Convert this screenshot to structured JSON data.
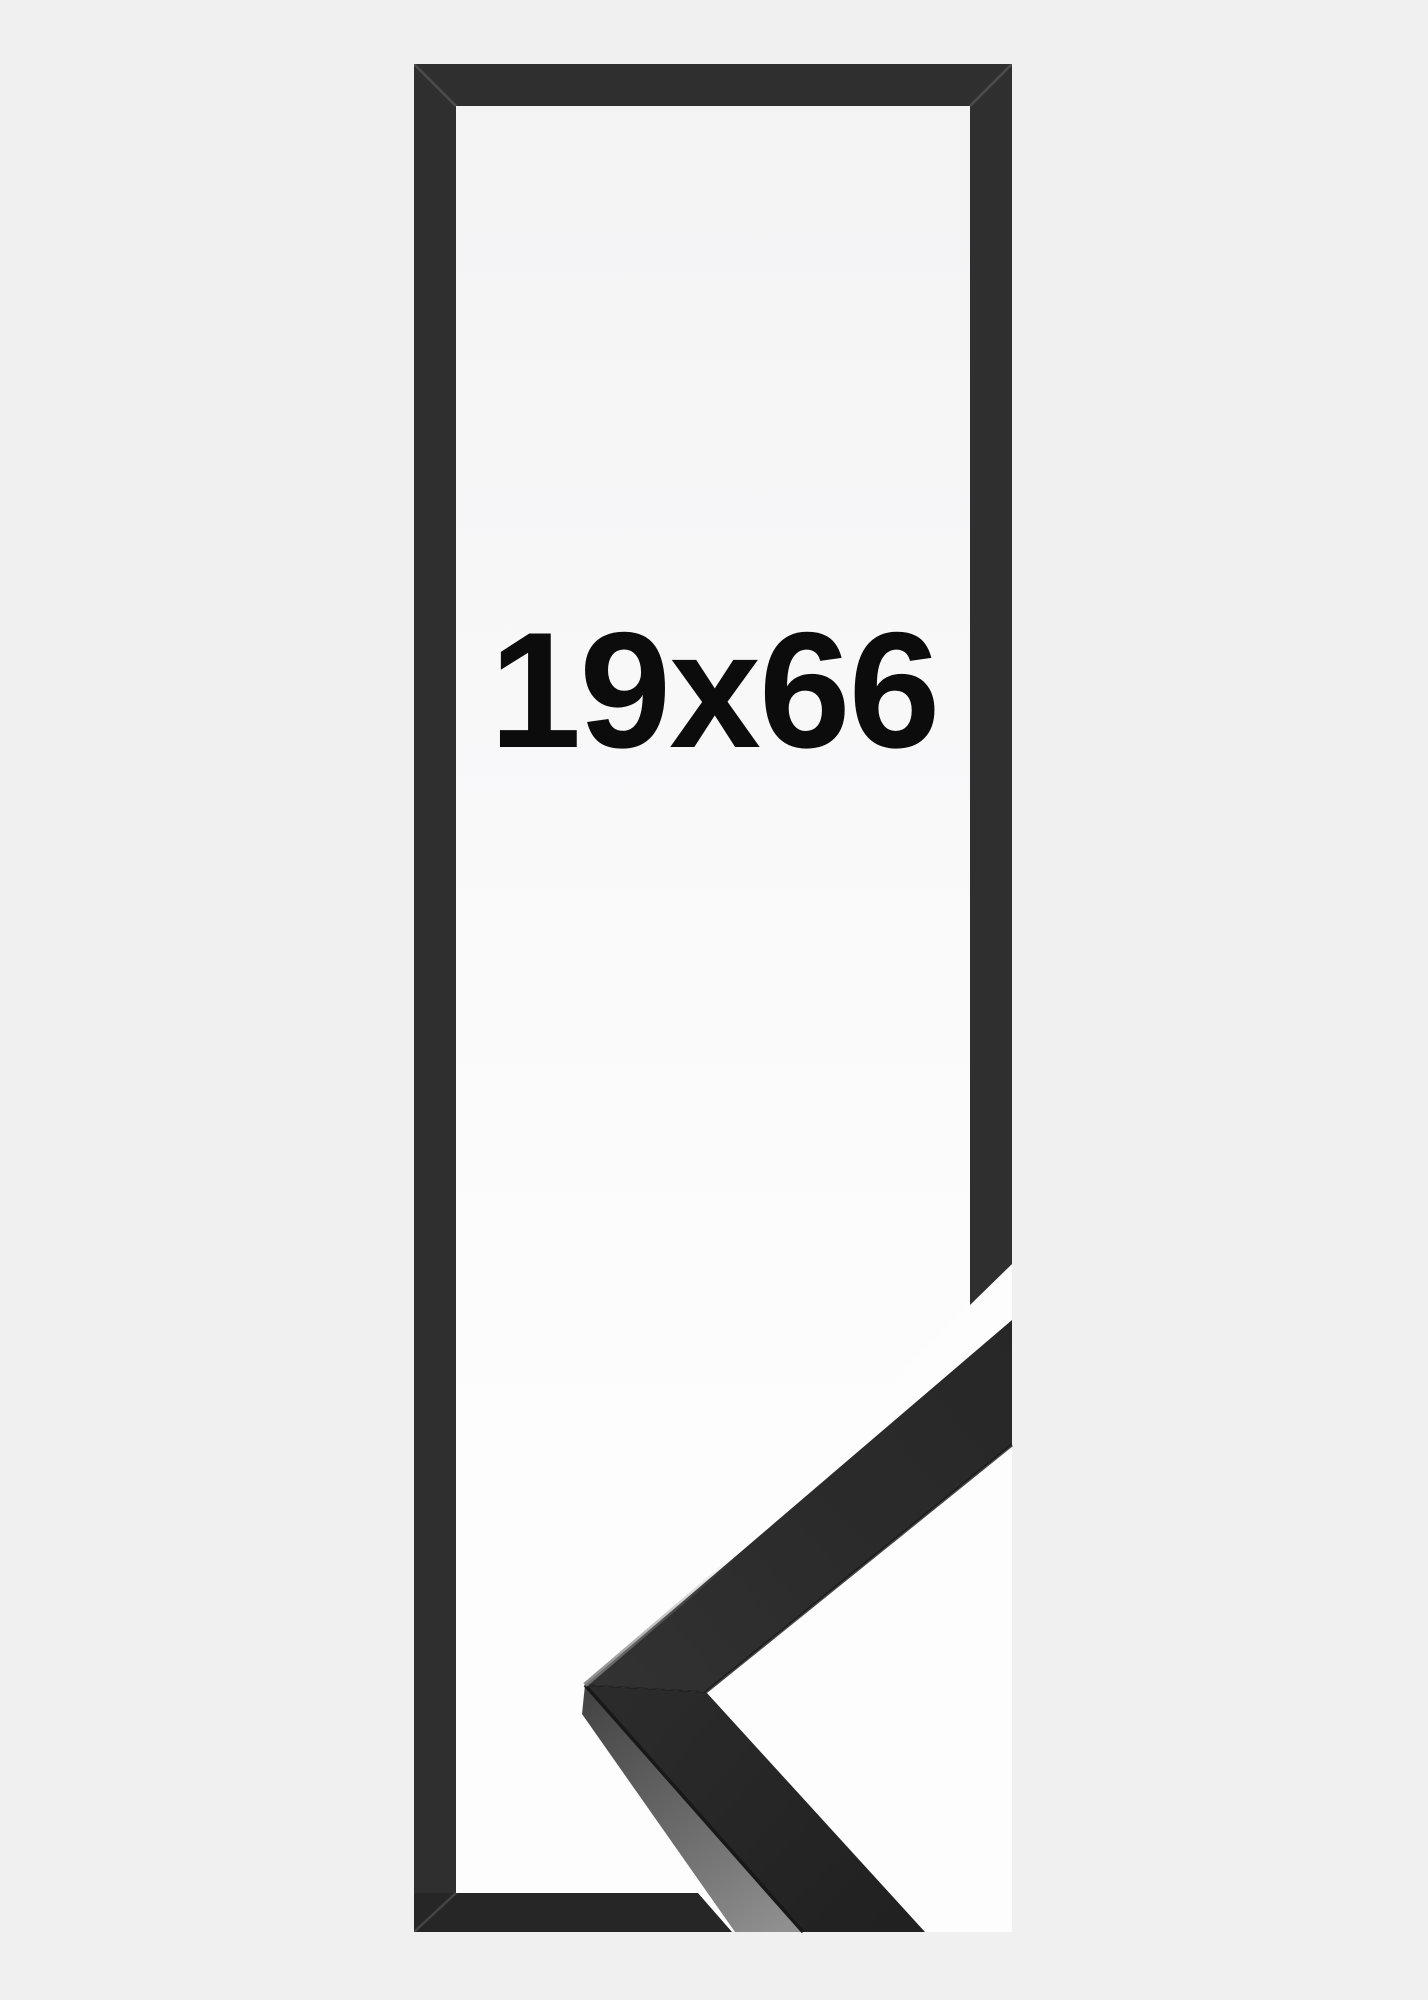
{
  "product_image": {
    "size_label": "19x66",
    "description": "black picture frame, tall narrow format, with moulding corner sample"
  },
  "colors": {
    "page_bg": "#f0f0f1",
    "frame_dark": "#2f2f2f",
    "frame_bottom_dark": "#262626",
    "opening_top": "#f3f3f4",
    "opening_mid": "#f9f9fa",
    "opening_bottom": "#fdfdfd",
    "sample_backdrop": "#fdfdfe",
    "moulding_face": "#2b2b2b",
    "moulding_face_deep": "#212121",
    "moulding_side_near": "#424242",
    "moulding_side_far": "#909090",
    "moulding_edge": "#181818",
    "label_text": "#0c0c0c"
  }
}
